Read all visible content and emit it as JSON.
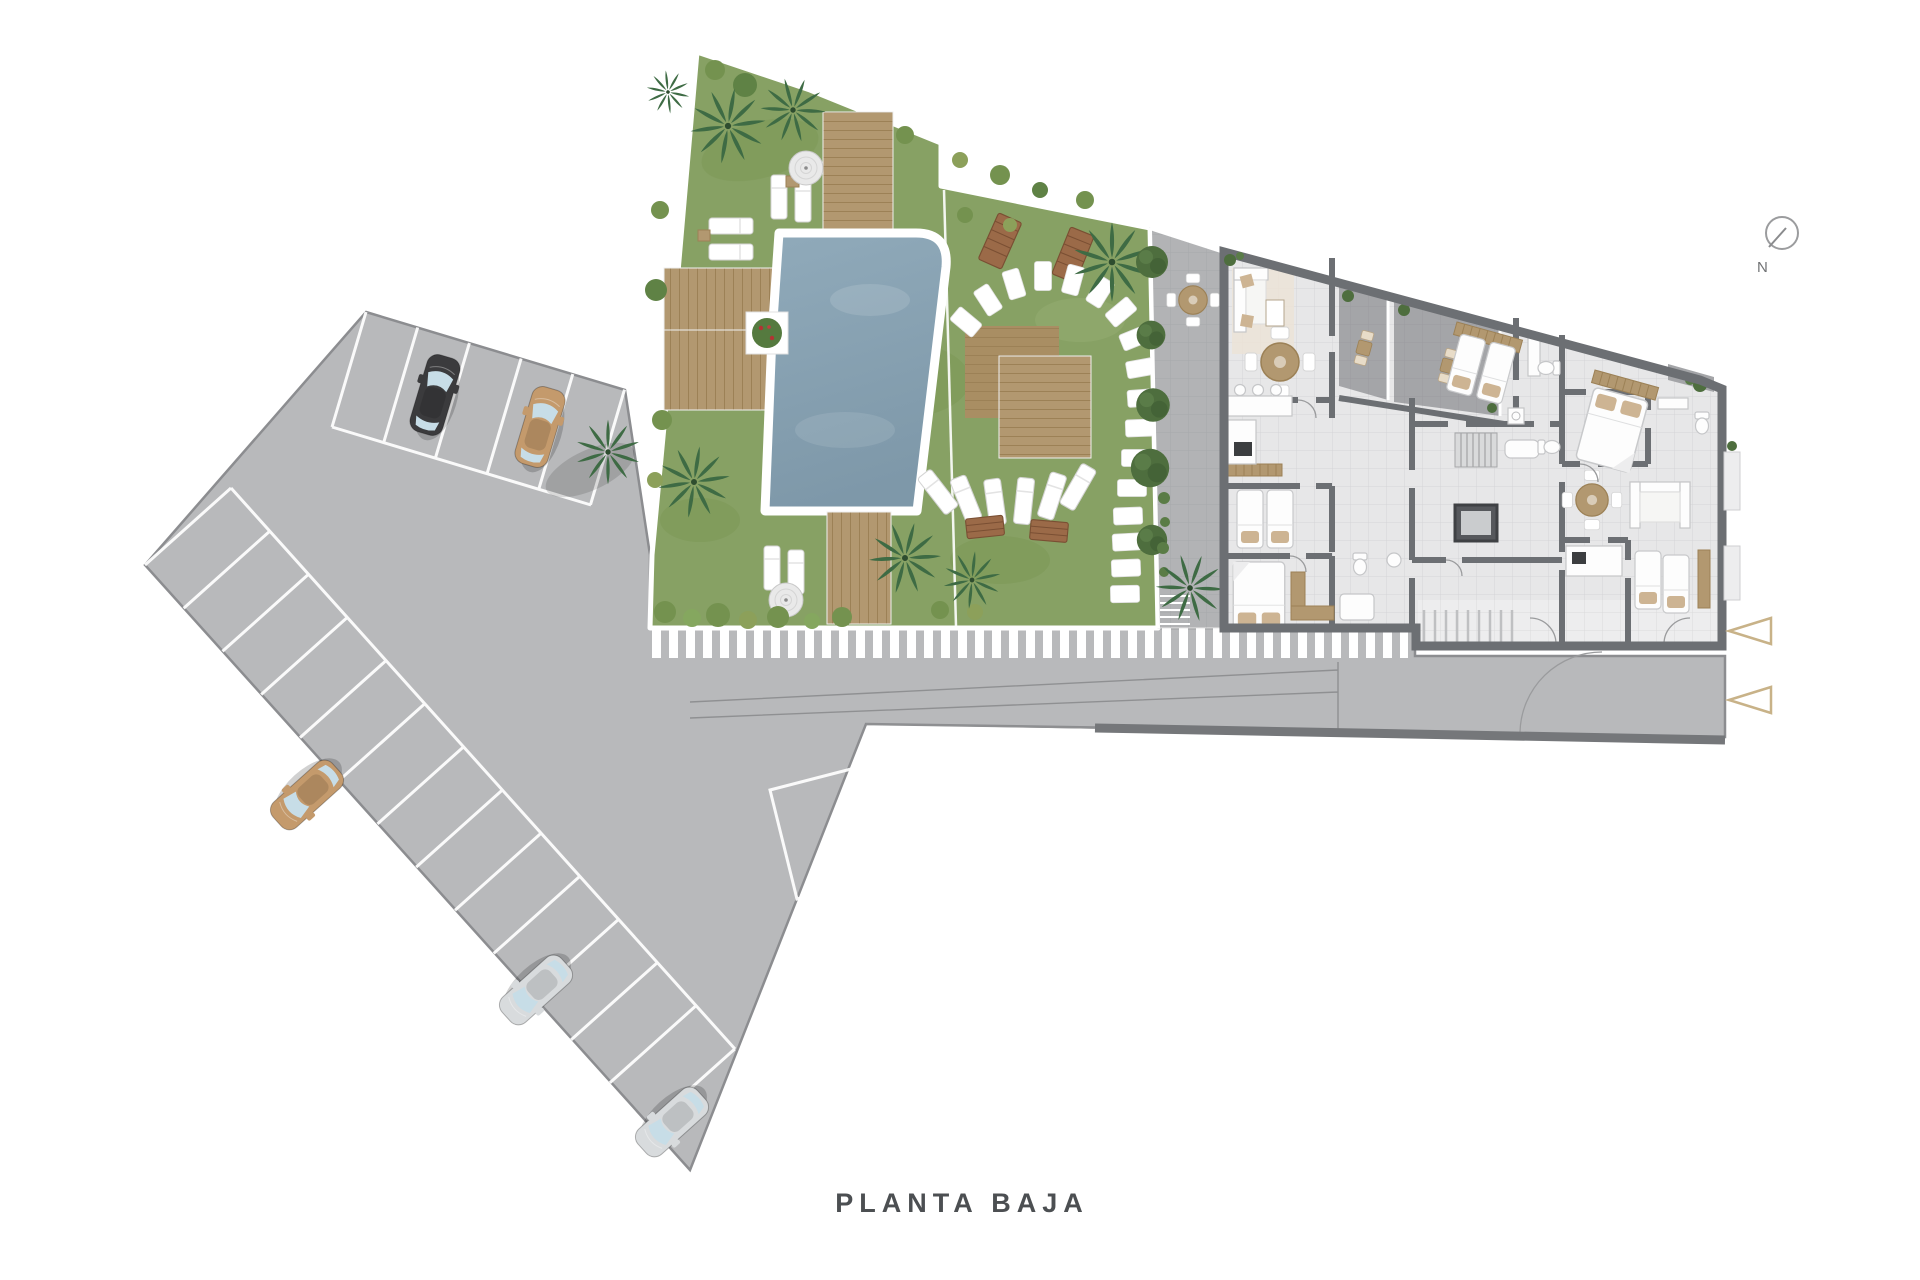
{
  "title": {
    "label": "PLANTA BAJA"
  },
  "compass": {
    "label": "N"
  },
  "colors": {
    "pavement": "#b8b9bb",
    "pavement_border": "#8c8d90",
    "road_wall": "#75777a",
    "grass": "#87a164",
    "grass_shade": "#77924f",
    "pool_water": "#90aaba",
    "pool_water_deep": "#7e98a9",
    "deck_wood": "#b29870",
    "deck_line": "#9c8156",
    "building_wall": "#6c6f73",
    "building_floor": "#e7e7e8",
    "terrace_floor": "#a4a5a8",
    "patio_floor": "#b2b3b5",
    "hedge_green": "#4e6e3e",
    "palm_green": "#3e6b44",
    "bush_green": "#74924f",
    "bench_wood": "#9b6a48",
    "car_black": "#3b3b3d",
    "car_tan": "#c49a6c",
    "car_silver": "#d8dbdd",
    "glass": "#c7dde7",
    "entrance_arrow": "#c8b288",
    "stripe_white": "#ffffff",
    "text_dark": "#4c4f52"
  },
  "scene": {
    "floor_label": "PLANTA BAJA",
    "areas": [
      "parking-lot",
      "pool-garden",
      "patio",
      "apartment-building",
      "access-road",
      "crosswalk"
    ],
    "cars": [
      {
        "color": "black"
      },
      {
        "color": "tan"
      },
      {
        "color": "tan"
      },
      {
        "color": "silver"
      },
      {
        "color": "silver"
      }
    ],
    "entrance_arrow_count": 2
  }
}
